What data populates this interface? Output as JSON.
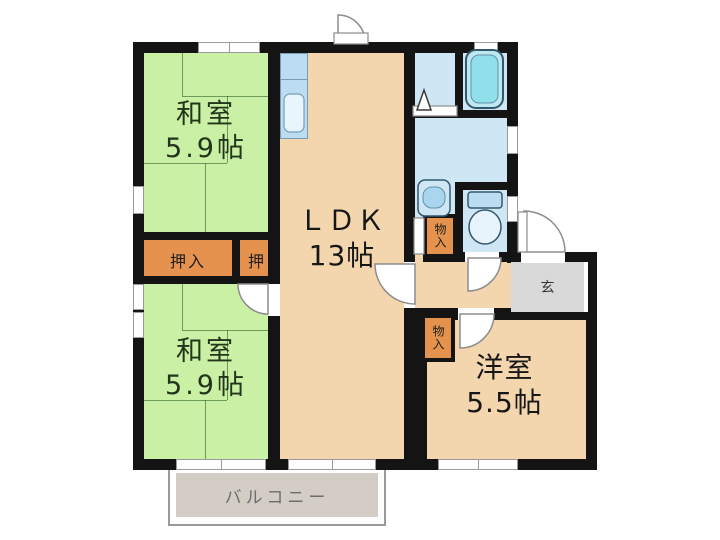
{
  "floor_plan": {
    "rooms": {
      "washitsu_top": {
        "name": "和室",
        "size": "5.9帖"
      },
      "washitsu_bottom": {
        "name": "和室",
        "size": "5.9帖"
      },
      "ldk": {
        "name": "ＬＤＫ",
        "size": "13帖"
      },
      "youshitsu": {
        "name": "洋室",
        "size": "5.5帖"
      }
    },
    "closets": {
      "oshiire": "押入",
      "oshi": "押",
      "monoire_upper": "物入",
      "monoire_lower": "物入"
    },
    "entrance_label": "玄",
    "balcony_label": "バルコニー",
    "colors": {
      "wall": "#141414",
      "tatami_green": "#c9f0a5",
      "wood_tan": "#f3d5ae",
      "closet_orange": "#e5924e",
      "wet_blue": "#cfe6f5",
      "bathtub_cyan": "#8fe0ea",
      "genkan_gray": "#d9d9d9",
      "balcony_gray": "#d4cdc5"
    }
  }
}
